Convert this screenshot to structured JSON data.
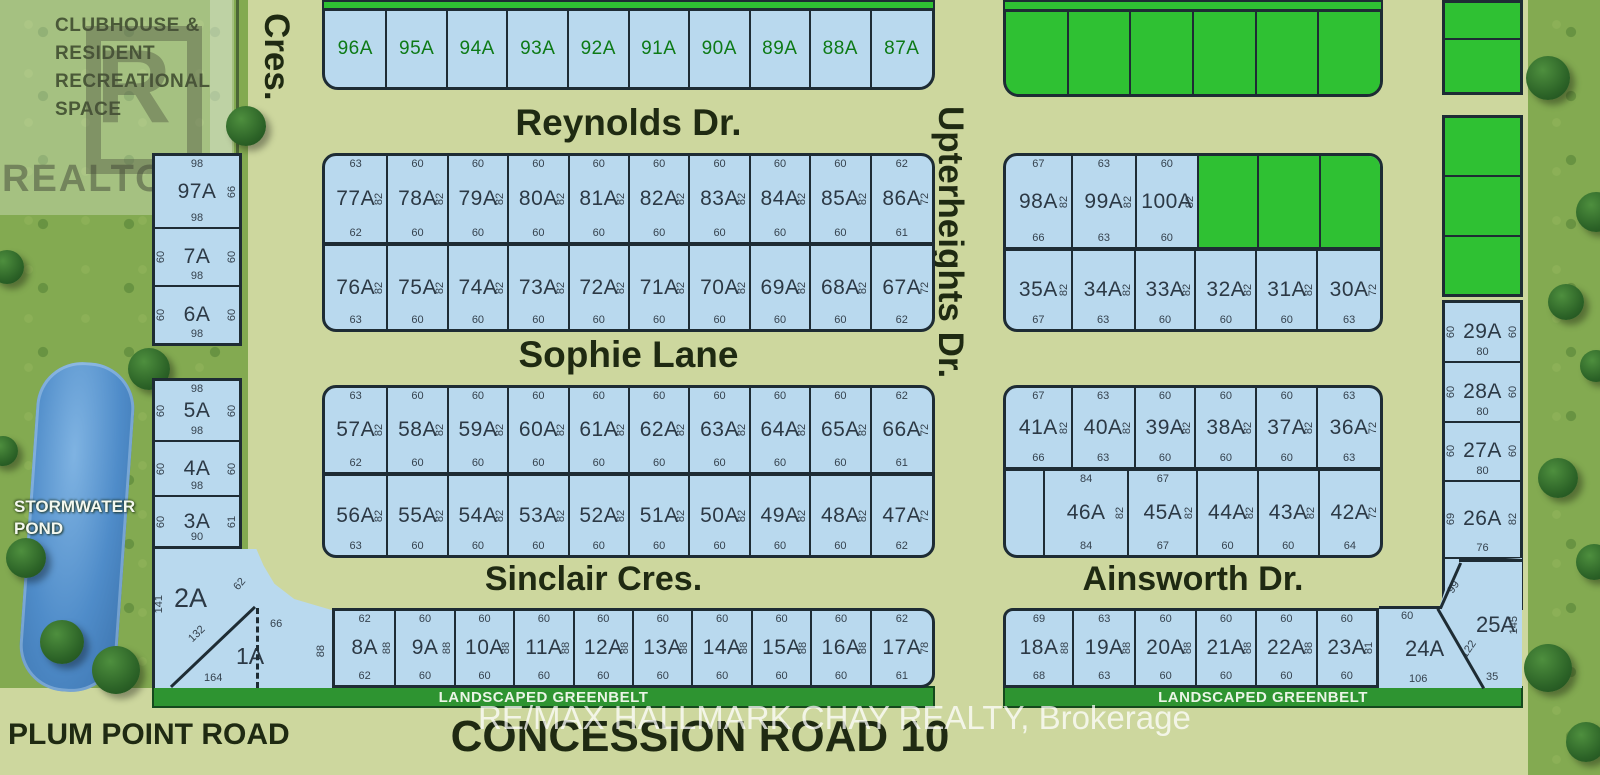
{
  "colors": {
    "road": "#cdd79e",
    "grass": "#83aa51",
    "lot_available": "#b9d9ee",
    "lot_sold": "#2fc133",
    "lot_border": "#1e2c34",
    "dimension_text": "#35424e",
    "lot_id_text": "#2c3945",
    "lot_id_green": "#0d7a16",
    "street_text": "#1f2a12",
    "greenbelt": "#2e9431",
    "greenbelt_text": "#eaf5e6",
    "pond": "#4b86c6",
    "watermark_text": "#ffffff"
  },
  "streets": {
    "reynolds": "Reynolds Dr.",
    "sophie": "Sophie Lane",
    "sinclair": "Sinclair Cres.",
    "ainsworth": "Ainsworth Dr.",
    "upterheights": "Upterheights Dr.",
    "cres": "Cres.",
    "concession": "CONCESSION ROAD 10",
    "plum_point": "PLUM POINT ROAD"
  },
  "areas": {
    "clubhouse_lines": [
      "CLUBHOUSE &",
      "RESIDENT",
      "RECREATIONAL",
      "SPACE"
    ],
    "stormwater_lines": [
      "STORMWATER",
      "POND"
    ],
    "greenbelt": "LANDSCAPED GREENBELT",
    "realtor": "REALTOR",
    "realtor_r": "R",
    "registered_mark": "®"
  },
  "watermark": {
    "text": "RE/MAX HALLMARK CHAY REALTY, Brokerage"
  },
  "rows": {
    "row_top": [
      {
        "id": "96A",
        "f": 63
      },
      {
        "id": "95A",
        "f": 61
      },
      {
        "id": "94A",
        "f": 61
      },
      {
        "id": "93A",
        "f": 61
      },
      {
        "id": "92A",
        "f": 61
      },
      {
        "id": "91A",
        "f": 61
      },
      {
        "id": "90A",
        "f": 61
      },
      {
        "id": "89A",
        "f": 61
      },
      {
        "id": "88A",
        "f": 61
      },
      {
        "id": "87A",
        "f": 63
      }
    ],
    "row_b": [
      {
        "id": "77A",
        "top": "63",
        "bottom": "62",
        "side": "82",
        "f": 63
      },
      {
        "id": "78A",
        "top": "60",
        "bottom": "60",
        "side": "82",
        "f": 60
      },
      {
        "id": "79A",
        "top": "60",
        "bottom": "60",
        "side": "82",
        "f": 60
      },
      {
        "id": "80A",
        "top": "60",
        "bottom": "60",
        "side": "82",
        "f": 60
      },
      {
        "id": "81A",
        "top": "60",
        "bottom": "60",
        "side": "82",
        "f": 60
      },
      {
        "id": "82A",
        "top": "60",
        "bottom": "60",
        "side": "82",
        "f": 60
      },
      {
        "id": "83A",
        "top": "60",
        "bottom": "60",
        "side": "82",
        "f": 60
      },
      {
        "id": "84A",
        "top": "60",
        "bottom": "60",
        "side": "82",
        "f": 60
      },
      {
        "id": "85A",
        "top": "60",
        "bottom": "60",
        "side": "82",
        "f": 60
      },
      {
        "id": "86A",
        "top": "62",
        "bottom": "61",
        "side": "72",
        "f": 62
      }
    ],
    "row_c": [
      {
        "id": "76A",
        "bottom": "63",
        "side": "82",
        "f": 63
      },
      {
        "id": "75A",
        "bottom": "60",
        "side": "82",
        "f": 60
      },
      {
        "id": "74A",
        "bottom": "60",
        "side": "82",
        "f": 60
      },
      {
        "id": "73A",
        "bottom": "60",
        "side": "82",
        "f": 60
      },
      {
        "id": "72A",
        "bottom": "60",
        "side": "82",
        "f": 60
      },
      {
        "id": "71A",
        "bottom": "60",
        "side": "82",
        "f": 60
      },
      {
        "id": "70A",
        "bottom": "60",
        "side": "82",
        "f": 60
      },
      {
        "id": "69A",
        "bottom": "60",
        "side": "82",
        "f": 60
      },
      {
        "id": "68A",
        "bottom": "60",
        "side": "82",
        "f": 60
      },
      {
        "id": "67A",
        "bottom": "62",
        "side": "72",
        "f": 62
      }
    ],
    "row_d": [
      {
        "id": "57A",
        "top": "63",
        "bottom": "62",
        "side": "82",
        "f": 63
      },
      {
        "id": "58A",
        "top": "60",
        "bottom": "60",
        "side": "82",
        "f": 60
      },
      {
        "id": "59A",
        "top": "60",
        "bottom": "60",
        "side": "82",
        "f": 60
      },
      {
        "id": "60A",
        "top": "60",
        "bottom": "60",
        "side": "82",
        "f": 60
      },
      {
        "id": "61A",
        "top": "60",
        "bottom": "60",
        "side": "82",
        "f": 60
      },
      {
        "id": "62A",
        "top": "60",
        "bottom": "60",
        "side": "82",
        "f": 60
      },
      {
        "id": "63A",
        "top": "60",
        "bottom": "60",
        "side": "82",
        "f": 60
      },
      {
        "id": "64A",
        "top": "60",
        "bottom": "60",
        "side": "82",
        "f": 60
      },
      {
        "id": "65A",
        "top": "60",
        "bottom": "60",
        "side": "82",
        "f": 60
      },
      {
        "id": "66A",
        "top": "62",
        "bottom": "61",
        "side": "72",
        "f": 62
      }
    ],
    "row_e": [
      {
        "id": "56A",
        "bottom": "63",
        "side": "82",
        "f": 63
      },
      {
        "id": "55A",
        "bottom": "60",
        "side": "82",
        "f": 60
      },
      {
        "id": "54A",
        "bottom": "60",
        "side": "82",
        "f": 60
      },
      {
        "id": "53A",
        "bottom": "60",
        "side": "82",
        "f": 60
      },
      {
        "id": "52A",
        "bottom": "60",
        "side": "82",
        "f": 60
      },
      {
        "id": "51A",
        "bottom": "60",
        "side": "82",
        "f": 60
      },
      {
        "id": "50A",
        "bottom": "60",
        "side": "82",
        "f": 60
      },
      {
        "id": "49A",
        "bottom": "60",
        "side": "82",
        "f": 60
      },
      {
        "id": "48A",
        "bottom": "60",
        "side": "82",
        "f": 60
      },
      {
        "id": "47A",
        "bottom": "62",
        "side": "72",
        "f": 62
      }
    ],
    "row_f": [
      {
        "id": "8A",
        "top": "62",
        "bottom": "62",
        "side": "88",
        "f": 62
      },
      {
        "id": "9A",
        "top": "60",
        "bottom": "60",
        "side": "88",
        "f": 60
      },
      {
        "id": "10A",
        "top": "60",
        "bottom": "60",
        "side": "88",
        "f": 60
      },
      {
        "id": "11A",
        "top": "60",
        "bottom": "60",
        "side": "88",
        "f": 60
      },
      {
        "id": "12A",
        "top": "60",
        "bottom": "60",
        "side": "88",
        "f": 60
      },
      {
        "id": "13A",
        "top": "60",
        "bottom": "60",
        "side": "88",
        "f": 60
      },
      {
        "id": "14A",
        "top": "60",
        "bottom": "60",
        "side": "88",
        "f": 60
      },
      {
        "id": "15A",
        "top": "60",
        "bottom": "60",
        "side": "88",
        "f": 60
      },
      {
        "id": "16A",
        "top": "60",
        "bottom": "60",
        "side": "88",
        "f": 60
      },
      {
        "id": "17A",
        "top": "62",
        "bottom": "61",
        "side": "78",
        "f": 63
      }
    ],
    "right_row1": [
      {
        "id": "98A",
        "top": "67",
        "bottom": "66",
        "side": "82",
        "f": 67
      },
      {
        "id": "99A",
        "top": "63",
        "bottom": "63",
        "side": "82",
        "f": 64
      },
      {
        "id": "100A",
        "top": "60",
        "bottom": "60",
        "side": "82",
        "f": 62
      },
      {
        "status": "sold",
        "f": 60
      },
      {
        "status": "sold",
        "f": 62
      },
      {
        "status": "sold",
        "f": 61
      }
    ],
    "right_row2": [
      {
        "id": "35A",
        "bottom": "67",
        "side": "82",
        "f": 67
      },
      {
        "id": "34A",
        "bottom": "63",
        "side": "82",
        "f": 63
      },
      {
        "id": "33A",
        "bottom": "60",
        "side": "82",
        "f": 61
      },
      {
        "id": "32A",
        "bottom": "60",
        "side": "82",
        "f": 61
      },
      {
        "id": "31A",
        "bottom": "60",
        "side": "82",
        "f": 61
      },
      {
        "id": "30A",
        "bottom": "63",
        "side": "72",
        "f": 64
      }
    ],
    "right_row3": [
      {
        "id": "41A",
        "top": "67",
        "bottom": "66",
        "side": "82",
        "f": 67
      },
      {
        "id": "40A",
        "top": "63",
        "bottom": "63",
        "side": "82",
        "f": 63
      },
      {
        "id": "39A",
        "top": "60",
        "bottom": "60",
        "side": "82",
        "f": 61
      },
      {
        "id": "38A",
        "top": "60",
        "bottom": "60",
        "side": "82",
        "f": 61
      },
      {
        "id": "37A",
        "top": "60",
        "bottom": "60",
        "side": "82",
        "f": 61
      },
      {
        "id": "36A",
        "top": "63",
        "bottom": "63",
        "side": "72",
        "f": 64
      }
    ],
    "right_row4": [
      {
        "f": 38
      },
      {
        "id": "46A",
        "top": "84",
        "bottom": "84",
        "side": "82",
        "f": 85
      },
      {
        "id": "45A",
        "top": "67",
        "bottom": "67",
        "side": "82",
        "f": 69
      },
      {
        "id": "44A",
        "bottom": "60",
        "side": "82",
        "f": 60
      },
      {
        "id": "43A",
        "bottom": "60",
        "side": "82",
        "f": 61
      },
      {
        "id": "42A",
        "bottom": "64",
        "side": "72",
        "f": 62
      }
    ],
    "right_row5": [
      {
        "id": "18A",
        "top": "69",
        "bottom": "68",
        "side": "88",
        "f": 69
      },
      {
        "id": "19A",
        "top": "63",
        "bottom": "63",
        "side": "88",
        "f": 63
      },
      {
        "id": "20A",
        "top": "60",
        "bottom": "60",
        "side": "88",
        "f": 61
      },
      {
        "id": "21A",
        "top": "60",
        "bottom": "60",
        "side": "88",
        "f": 61
      },
      {
        "id": "22A",
        "top": "60",
        "bottom": "60",
        "side": "88",
        "f": 61
      },
      {
        "id": "23A",
        "top": "60",
        "bottom": "60",
        "side": "81",
        "f": 61
      }
    ],
    "left_col1": [
      {
        "id": "97A",
        "top": "98",
        "bottom": "98",
        "right": "66",
        "f": 75
      },
      {
        "id": "7A",
        "left": "60",
        "right": "60",
        "bottom": "98",
        "f": 59
      },
      {
        "id": "6A",
        "left": "60",
        "right": "60",
        "bottom": "98",
        "f": 59
      }
    ],
    "left_col2": [
      {
        "id": "5A",
        "top": "98",
        "left": "60",
        "right": "60",
        "bottom": "98",
        "f": 63
      },
      {
        "id": "4A",
        "left": "60",
        "right": "60",
        "bottom": "98",
        "f": 56
      },
      {
        "id": "3A",
        "left": "60",
        "right": "61",
        "bottom": "90",
        "f": 52
      }
    ],
    "right_col": [
      {
        "id": "29A",
        "left": "60",
        "right": "60",
        "bottom": "80",
        "f": 60
      },
      {
        "id": "28A",
        "left": "60",
        "right": "60",
        "bottom": "80",
        "f": 59
      },
      {
        "id": "27A",
        "left": "60",
        "right": "60",
        "bottom": "80",
        "f": 59
      },
      {
        "id": "26A",
        "left": "69",
        "right": "82",
        "bottom": "76",
        "f": 77
      },
      {
        "f": 50
      }
    ],
    "sold_top_row": [
      {
        "status": "sold"
      },
      {
        "status": "sold"
      },
      {
        "status": "sold"
      },
      {
        "status": "sold"
      },
      {
        "status": "sold"
      },
      {
        "status": "sold"
      }
    ],
    "far_right_top": [
      {
        "status": "sold",
        "f": 38
      },
      {
        "status": "sold",
        "f": 57
      }
    ],
    "far_right_mid": [
      {
        "status": "sold"
      },
      {
        "status": "sold"
      },
      {
        "status": "sold"
      }
    ]
  },
  "corner_sw": {
    "lot_2": "2A",
    "lot_1": "1A",
    "dim_141": "141",
    "dim_132": "132",
    "dim_62": "62",
    "dim_164": "164",
    "dim_66": "66",
    "dim_88": "88"
  },
  "corner_se": {
    "lot_24": "24A",
    "dim_60": "60",
    "dim_106": "106",
    "lot_25": "25A",
    "dim_99": "99",
    "dim_122": "122",
    "dim_145": "145",
    "dim_35": "35"
  }
}
